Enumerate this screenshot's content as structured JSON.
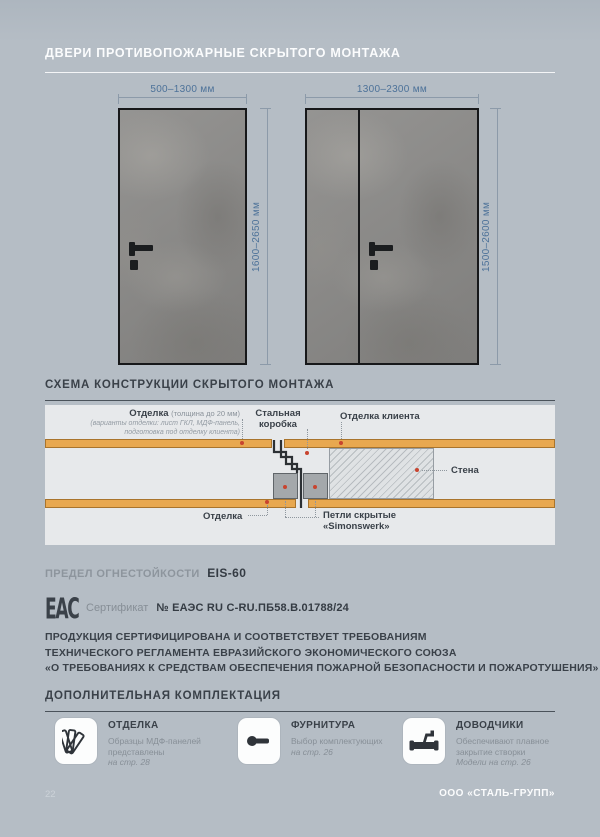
{
  "header": {
    "title": "ДВЕРИ ПРОТИВОПОЖАРНЫЕ СКРЫТОГО МОНТАЖА"
  },
  "doors": {
    "single": {
      "width_label": "500–1300 мм",
      "height_label": "1600–2650 мм"
    },
    "double": {
      "width_label": "1300–2300 мм",
      "height_label": "1500–2600 мм"
    }
  },
  "schema": {
    "title": "СХЕМА КОНСТРУКЦИИ СКРЫТОГО МОНТАЖА",
    "finish_label": "Отделка",
    "finish_note": "(толщина до 20 мм)",
    "finish_sub1": "(варианты отделки: лист ГКЛ, МДФ-панель,",
    "finish_sub2": "подготовка под отделку клиента)",
    "steel_frame_line1": "Стальная",
    "steel_frame_line2": "коробка",
    "client_finish_label": "Отделка клиента",
    "wall_label": "Стена",
    "bottom_finish_label": "Отделка",
    "hinges_line1": "Петли скрытые",
    "hinges_line2": "«Simonswerk»"
  },
  "fire_rating": {
    "label": "ПРЕДЕЛ ОГНЕСТОЙКОСТИ",
    "value": "EIS-60"
  },
  "certificate": {
    "eac_mark_text": "ЕАС",
    "label": "Сертификат",
    "number": "№ ЕАЭС RU C-RU.ПБ58.В.01788/24"
  },
  "compliance": {
    "line1": "ПРОДУКЦИЯ СЕРТИФИЦИРОВАНА И СООТВЕТСТВУЕТ ТРЕБОВАНИЯМ",
    "line2": "ТЕХНИЧЕСКОГО РЕГЛАМЕНТА ЕВРАЗИЙСКОГО ЭКОНОМИЧЕСКОГО СОЮЗА",
    "line3": "«О ТРЕБОВАНИЯХ К СРЕДСТВАМ ОБЕСПЕЧЕНИЯ ПОЖАРНОЙ БЕЗОПАСНОСТИ И ПОЖАРОТУШЕНИЯ»"
  },
  "extras": {
    "title": "ДОПОЛНИТЕЛЬНАЯ КОМПЛЕКТАЦИЯ",
    "cards": [
      {
        "title": "ОТДЕЛКА",
        "icon": "panels-fan-icon",
        "line1": "Образцы МДФ-панелей",
        "line2": "представлены",
        "italic_line": "на стр. 28"
      },
      {
        "title": "ФУРНИТУРА",
        "icon": "door-handle-icon",
        "line1": "Выбор комплектующих",
        "line2": "",
        "italic_line": "на стр. 26"
      },
      {
        "title": "ДОВОДЧИКИ",
        "icon": "door-closer-icon",
        "line1": "Обеспечивают плавное",
        "line2": "закрытие створки",
        "italic_line": "Модели на стр. 26"
      }
    ]
  },
  "footer": {
    "page_number": "22",
    "company": "ООО «СТАЛЬ-ГРУПП»"
  },
  "colors": {
    "background": "#b5bdc5",
    "dark_text": "#3a4149",
    "gray_text": "#8a929a",
    "dimension_blue": "#4d7299",
    "accent_orange": "#e8a850",
    "leader_dot_red": "#c8442f",
    "panel_background": "#e7e9eb"
  }
}
